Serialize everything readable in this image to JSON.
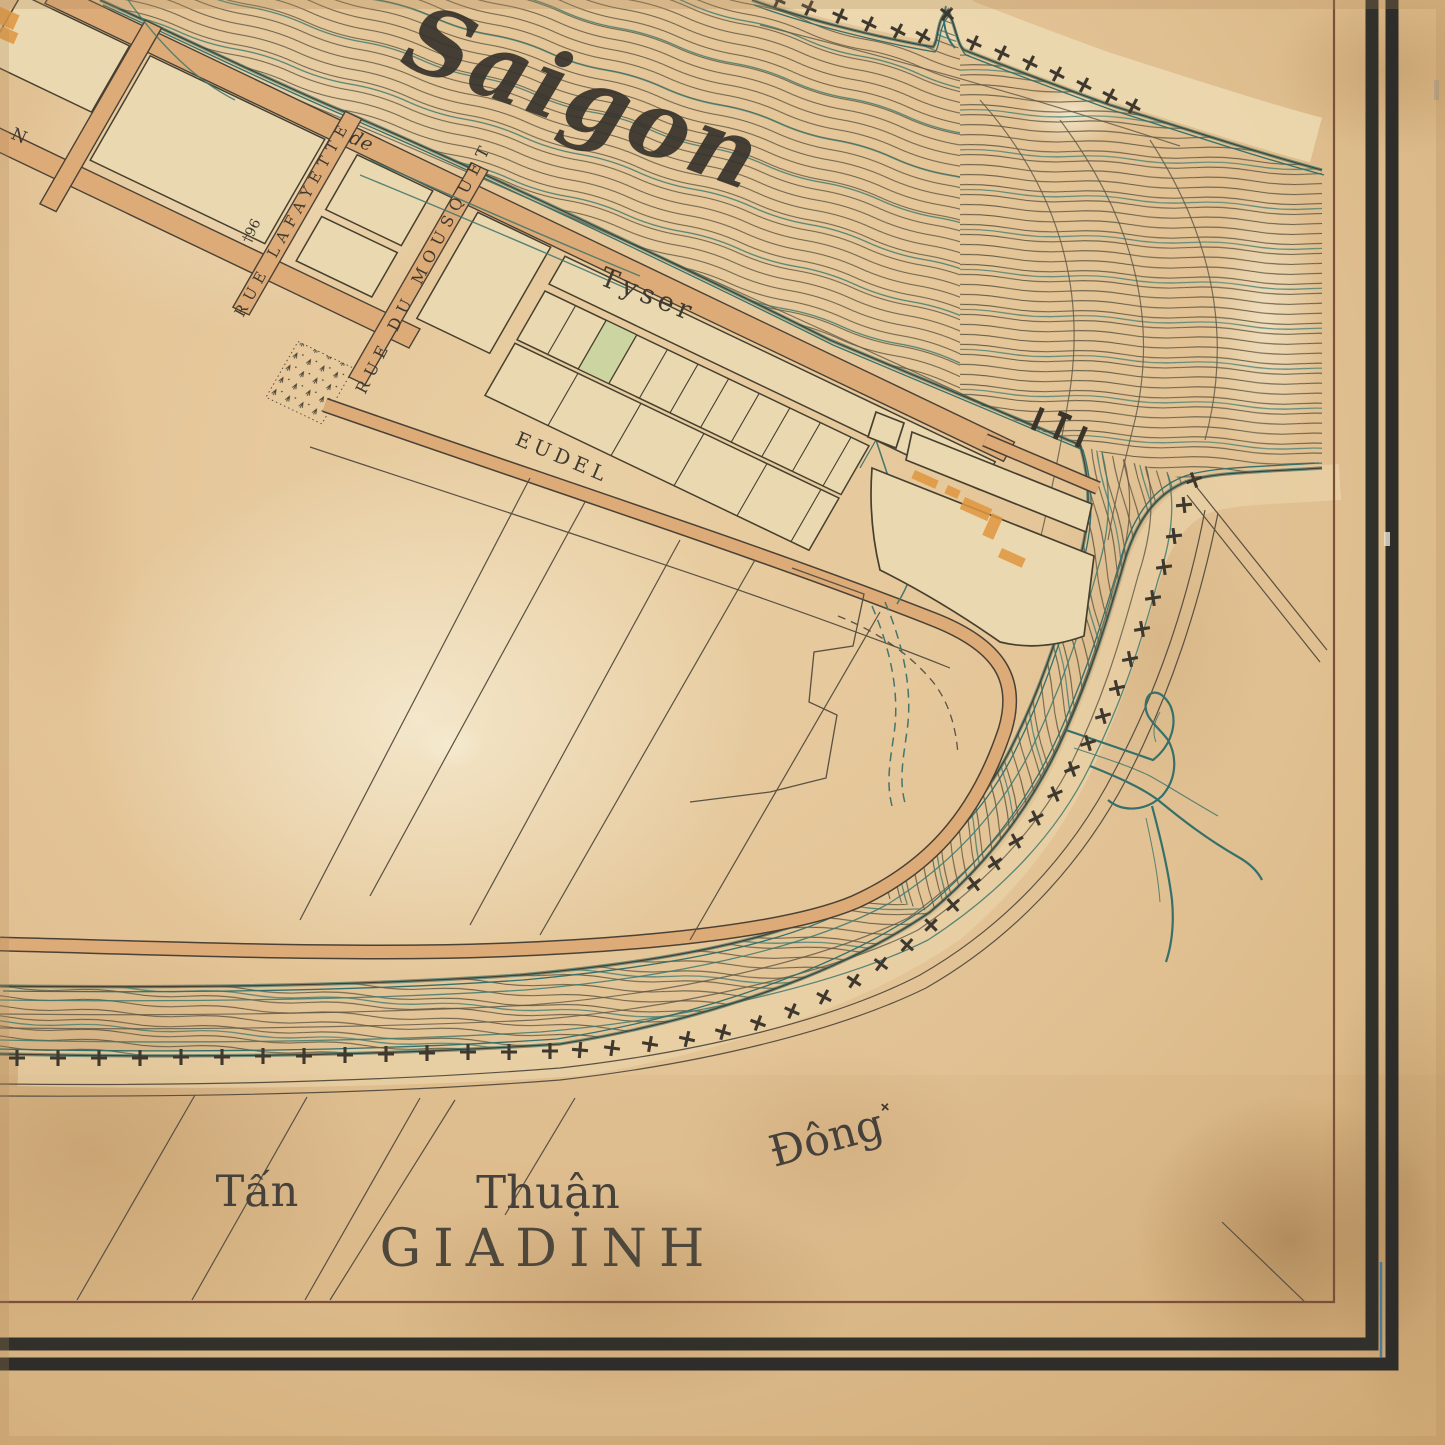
{
  "map": {
    "name": "historic-saigon-plan",
    "labels": {
      "river": "Saigon",
      "wharf": "Tyser",
      "street_eudel": "EUDEL",
      "street_lafayette": "RUE LAFAYETTE",
      "street_mousquet": "RUE DU MOUSQUET",
      "fragment_de": "de",
      "fragment_n": "N",
      "benchmark": "†96",
      "village_tan": "Tấn",
      "village_thuan": "Thuận",
      "village_dong": "Đông",
      "province": "GIADINH"
    },
    "colors": {
      "parchment": "#e2c191",
      "parchment_light": "#f0e2c0",
      "road_fill": "#ddab77",
      "block_fill": "#ead8b0",
      "lot_green": "#ccd5a1",
      "building_orange": "#e0973f",
      "flow_line": "#6a5f47",
      "shore_teal": "#35706a",
      "ink": "#3d382e",
      "frame_band": "#31302b",
      "frame_inner": "#7c4f38",
      "margin_blue": "#2e6f9e"
    }
  }
}
